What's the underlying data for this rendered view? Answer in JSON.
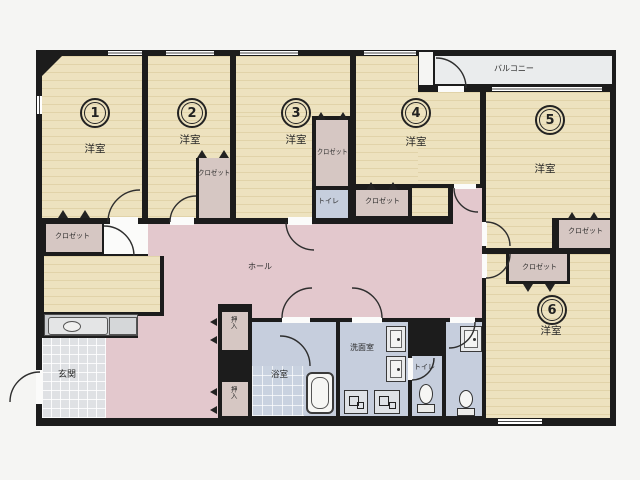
{
  "plan": {
    "type": "apartment-floor-plan",
    "rooms": [
      {
        "number": "1",
        "type": "洋室"
      },
      {
        "number": "2",
        "type": "洋室"
      },
      {
        "number": "3",
        "type": "洋室"
      },
      {
        "number": "4",
        "type": "洋室"
      },
      {
        "number": "5",
        "type": "洋室"
      },
      {
        "number": "6",
        "type": "洋室"
      }
    ],
    "labels": {
      "hall": "ホール",
      "balcony": "バルコニー",
      "entrance": "玄関",
      "bath": "浴室",
      "washroom": "洗面室",
      "toilet": "トイレ",
      "closet": "クロゼット",
      "storage": "押入"
    },
    "colors": {
      "room_floor": "#ede2bf",
      "hall_floor": "#e3c8cd",
      "wet_floor": "#c6cedd",
      "closet_floor": "#d6c7c3",
      "entry_tile": "#dfe1e4",
      "balcony": "#eaeced",
      "wall": "#1c1c1c",
      "paper": "#f5f5f3"
    }
  }
}
